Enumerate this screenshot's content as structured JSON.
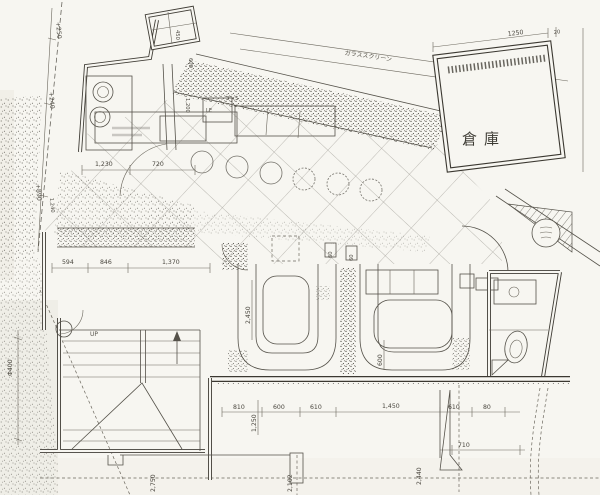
{
  "colors": {
    "paper": "#f7f6f1",
    "ink": "#3f3c35",
    "faint_ink": "#6b675d"
  },
  "rooms": {
    "warehouse": "倉庫"
  },
  "annotations": {
    "up": "UP",
    "glass_screen": "ガラススクリーン",
    "le": "LE",
    "size_3x5": "3'×5"
  },
  "dims": {
    "top_1250": "1250",
    "top_20": "20",
    "left_plus250": "+250",
    "left_plus240": "+240",
    "left_plus890": "+890",
    "left_1240": "1,240",
    "mid_1230": "1,230",
    "mid_720": "720",
    "row_594": "594",
    "row_846": "846",
    "row_1370": "1,370",
    "v_450": "450",
    "v_600a": "600",
    "v_1200": "1,200",
    "booth_2450": "2,450",
    "booth_600": "600",
    "tiny_60a": "60",
    "tiny_60b": "60",
    "bottom_810": "810",
    "bottom_600": "600",
    "bottom_610a": "610",
    "bottom_1450": "1,450",
    "bottom_610b": "610",
    "bottom_80": "80",
    "bottom_710": "710",
    "v_1250": "1,250",
    "v_2750": "2,750",
    "v_2102": "2,102",
    "v_2440": "2,440",
    "v_phi400": "Φ400"
  }
}
